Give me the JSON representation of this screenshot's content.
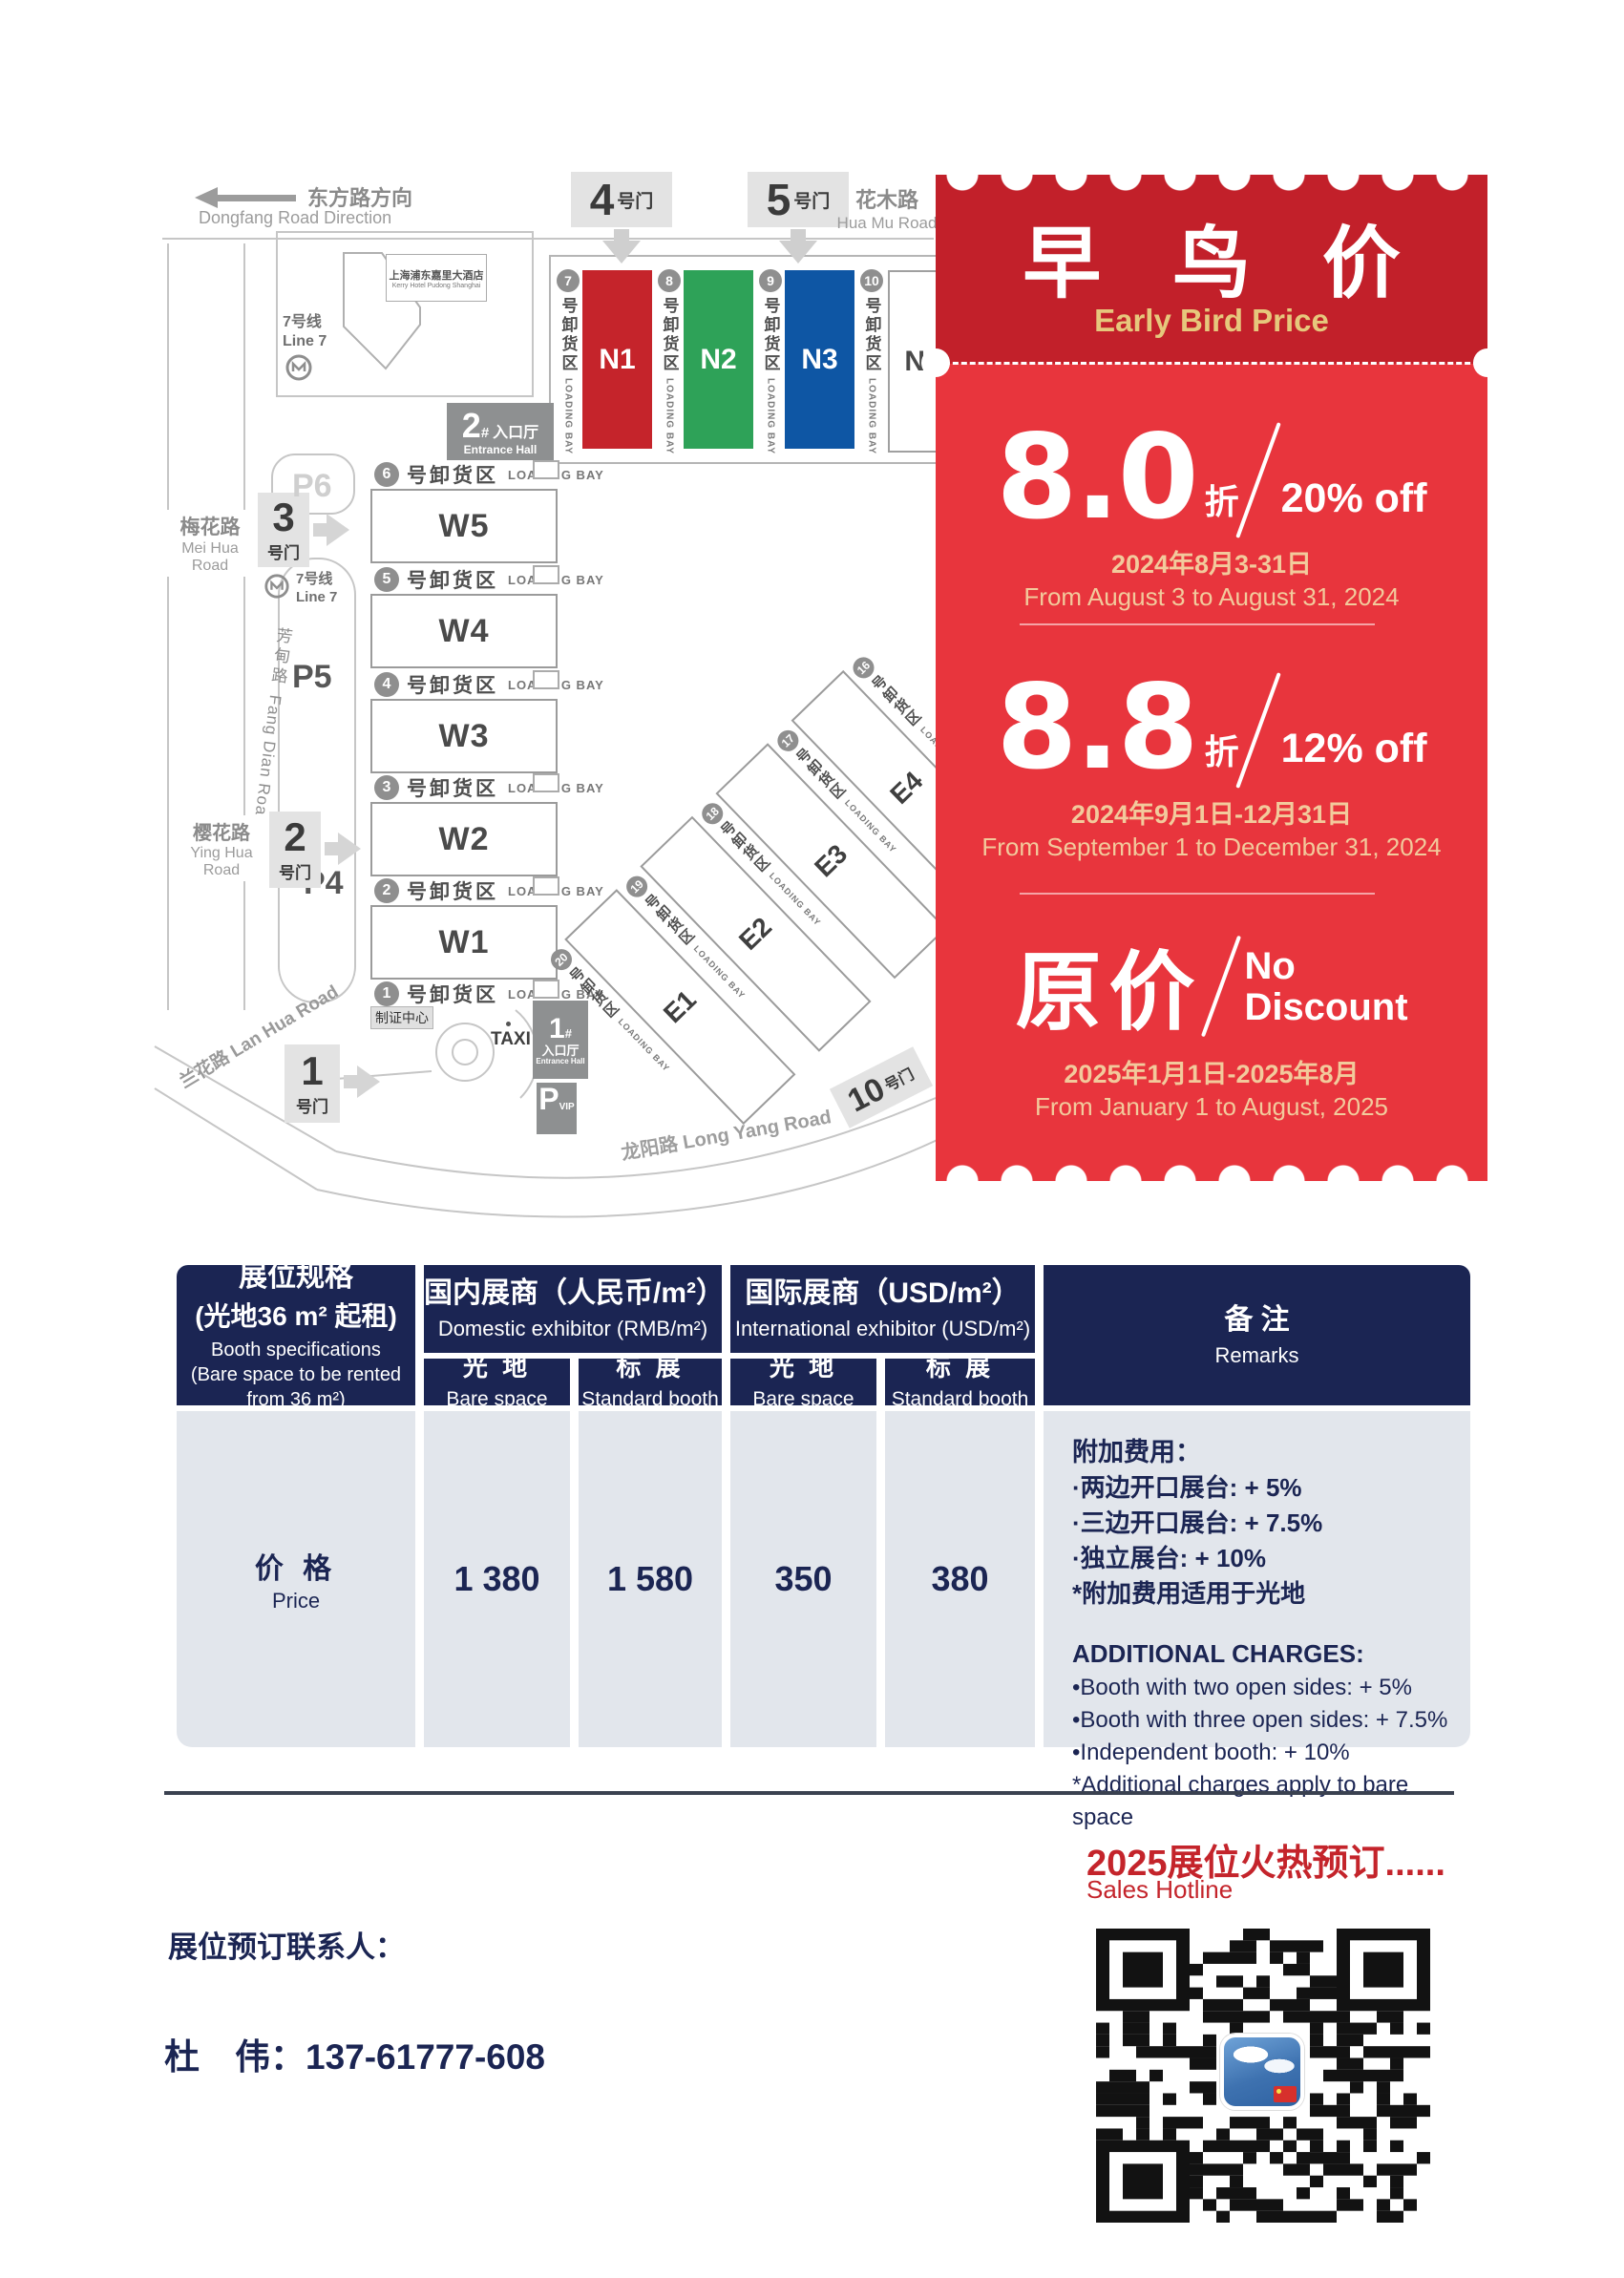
{
  "colors": {
    "navy": "#1B2553",
    "ticket_header_red": "#C2202A",
    "ticket_body_red": "#E8353D",
    "gold_text": "#E6C77C",
    "tan_date_text": "#F2CA9C",
    "accent_red": "#C4242B",
    "hall_n1_red": "#C5242B",
    "hall_n2_green": "#2EA258",
    "hall_n3_blue": "#0E56A4",
    "table_body_gray": "#E2E6EC"
  },
  "map": {
    "dongfang_zh": "东方路方向",
    "dongfang_en": "Dongfang Road Direction",
    "huamu_zh": "花木路",
    "huamu_en": "Hua Mu Road",
    "meihua_zh": "梅花路",
    "meihua_en": "Mei Hua Road",
    "yinghua_zh": "樱花路",
    "yinghua_en": "Ying Hua Road",
    "fangdian_zh": "芳甸路",
    "fangdian_en": "Fang Dian Road",
    "lanhua": "兰花路 Lan Hua Road",
    "longyang": "龙阳路  Long Yang Road",
    "hotel_zh": "上海浦东嘉里大酒店",
    "hotel_en": "Kerry Hotel Pudong Shanghai",
    "line7_zh": "7号线",
    "line7_en": "Line 7",
    "gate_suffix": "号门",
    "gate4_num": "4",
    "gate5_num": "5",
    "gate3_num": "3",
    "gate2_num": "2",
    "gate1_num": "1",
    "gate10_num": "10",
    "p4": "P4",
    "p5": "P5",
    "p6": "P6",
    "entrance2_num": "2",
    "entrance2_hash": "#",
    "entrance1_num": "1",
    "entrance1_hash": "#",
    "entrance_hall_zh": "入口厅",
    "entrance_hall_en": "Entrance Hall",
    "pvip_p": "P",
    "pvip_vip": "VIP",
    "taxi": "TAXI",
    "badge_center": "制证中心",
    "bay_zh": "号卸货区",
    "bay_en": "LOADING BAY",
    "n_bays": [
      "7",
      "8",
      "9",
      "10"
    ],
    "n_halls": [
      "N1",
      "N2",
      "N3",
      "N4"
    ],
    "w_bays": [
      "6",
      "5",
      "4",
      "3",
      "2",
      "1"
    ],
    "w_halls": [
      "W5",
      "W4",
      "W3",
      "W2",
      "W1"
    ],
    "e_bays": [
      "20",
      "19",
      "18",
      "17",
      "16"
    ],
    "e_halls": [
      "E1",
      "E2",
      "E3",
      "E4"
    ]
  },
  "ticket": {
    "title_zh": "早 鸟 价",
    "title_en": "Early Bird Price",
    "tiers": [
      {
        "rate": "8.0",
        "unit": "折",
        "discount": "20% off",
        "date_zh": "2024年8月3-31日",
        "date_en": "From August 3 to August 31, 2024"
      },
      {
        "rate": "8.8",
        "unit": "折",
        "discount": "12% off",
        "date_zh": "2024年9月1日-12月31日",
        "date_en": "From September 1 to December 31, 2024"
      },
      {
        "rate": "原价",
        "discount_line1": "No",
        "discount_line2": "Discount",
        "date_zh": "2025年1月1日-2025年8月",
        "date_en": "From January 1 to August, 2025"
      }
    ]
  },
  "table": {
    "spec_zh1": "展位规格",
    "spec_zh2": "(光地36 m² 起租)",
    "spec_en1": "Booth specifications",
    "spec_en2": "(Bare space to be rented from 36 m²)",
    "domestic_zh": "国内展商（人民币/m²）",
    "domestic_en": "Domestic exhibitor (RMB/m²)",
    "intl_zh": "国际展商（USD/m²）",
    "intl_en": "International exhibitor (USD/m²)",
    "bare_zh": "光 地",
    "bare_en": "Bare space",
    "standard_zh": "标 展",
    "standard_en": "Standard booth",
    "remarks_zh": "备 注",
    "remarks_en": "Remarks",
    "price_zh": "价 格",
    "price_en": "Price",
    "values": [
      "1 380",
      "1 580",
      "350",
      "380"
    ],
    "extra_zh_title": "附加费用：",
    "extra_zh": [
      "·两边开口展台: + 5%",
      "·三边开口展台: + 7.5%",
      "·独立展台: + 10%",
      "*附加费用适用于光地"
    ],
    "extra_en_title": "ADDITIONAL CHARGES:",
    "extra_en": [
      "•Booth with two open sides: + 5%",
      "•Booth with three open sides: + 7.5%",
      "•Independent booth: + 10%",
      "*Additional charges apply to bare space"
    ]
  },
  "footer": {
    "hot": "2025展位火热预订......",
    "hotline": "Sales Hotline",
    "contact_label": "展位预订联系人：",
    "contact_phone": "杜　伟：137-61777-608"
  }
}
